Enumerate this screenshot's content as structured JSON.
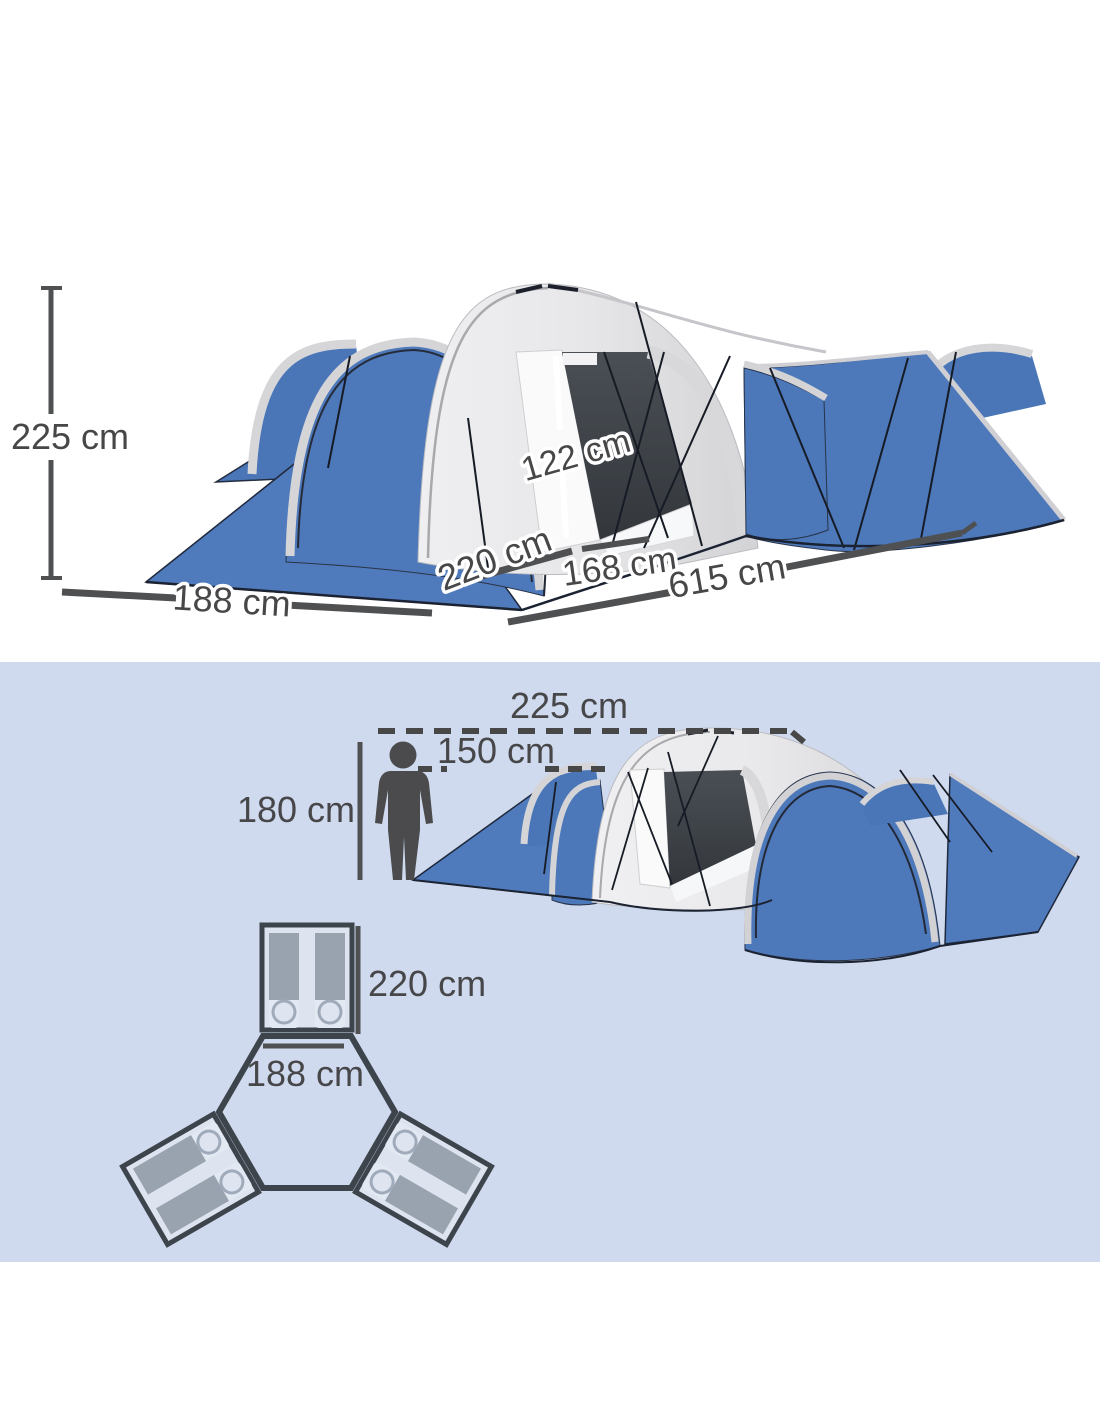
{
  "colors": {
    "section_bottom_background": "#cfdaef",
    "tent_blue": "#4d79bb",
    "tent_blue_dark": "#4a76b8",
    "tent_canvas_grey": "#e6e6e8",
    "door_dark": "#41464c",
    "dimension_grey": "#4a4a4c",
    "floorplan_border": "#3d444c",
    "sleeping_bag_grey": "#99a3b0"
  },
  "top_diagram": {
    "tent_height_label": "225 cm",
    "door_height_label": "122 cm",
    "bedroom_width_label": "188 cm",
    "bedroom_depth_label": "220 cm",
    "door_width_label": "168 cm",
    "total_length_label": "615 cm"
  },
  "bottom_diagram": {
    "tent_height_label": "225 cm",
    "door_height_label": "150 cm",
    "person_height_label": "180 cm",
    "bedroom_depth_label": "220 cm",
    "bedroom_width_label": "188 cm"
  }
}
